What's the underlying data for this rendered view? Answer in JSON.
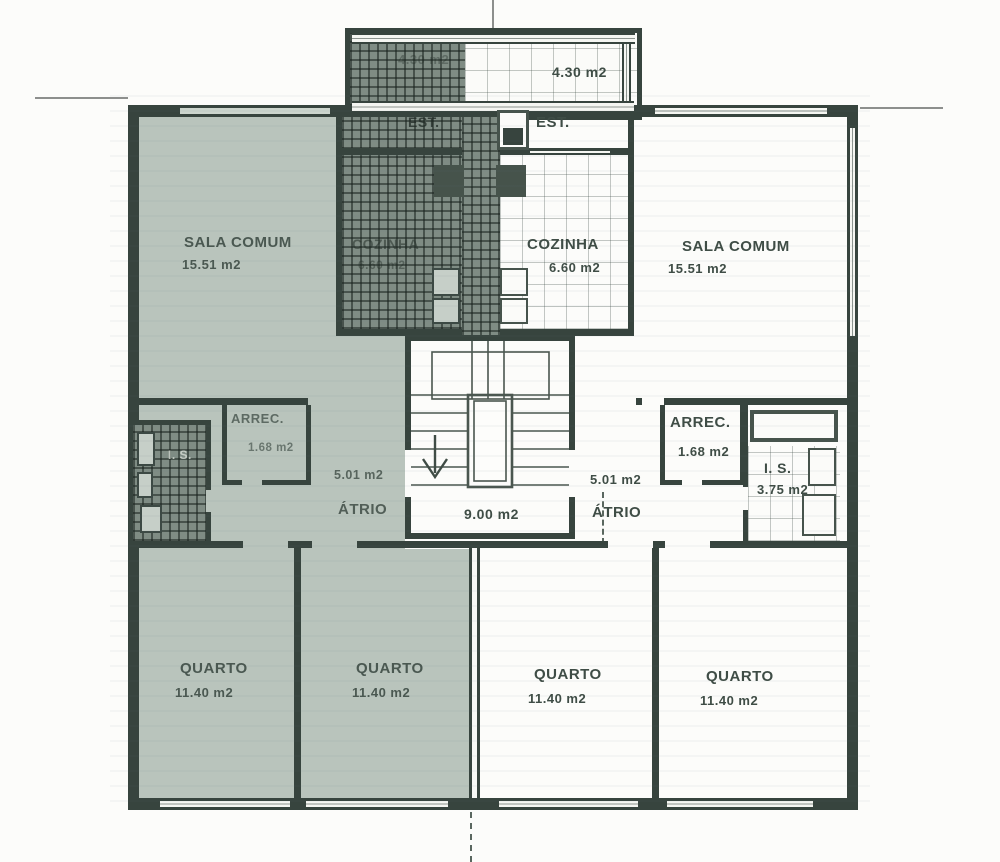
{
  "colors": {
    "highlight_tint": "#b9c4bc",
    "wall_ink": "#37443e",
    "text_ink": "#3f4d46"
  },
  "rooms": {
    "left_est": {
      "name": "EST.",
      "area": "4.30 m2"
    },
    "right_est": {
      "name": "EST.",
      "area": "4.30 m2"
    },
    "left_sala": {
      "name": "SALA COMUM",
      "area": "15.51 m2"
    },
    "right_sala": {
      "name": "SALA COMUM",
      "area": "15.51 m2"
    },
    "left_cozinha": {
      "name": "COZINHA",
      "area": "6.60 m2"
    },
    "right_cozinha": {
      "name": "COZINHA",
      "area": "6.60 m2"
    },
    "left_arrec": {
      "name": "ARREC.",
      "area": "1.68 m2"
    },
    "right_arrec": {
      "name": "ARREC.",
      "area": "1.68 m2"
    },
    "left_is": {
      "name": "I. S."
    },
    "right_is": {
      "name": "I. S.",
      "area": "3.75 m2"
    },
    "left_atrio": {
      "name": "ÁTRIO",
      "area": "5.01 m2"
    },
    "right_atrio": {
      "name": "ÁTRIO",
      "area": "5.01 m2"
    },
    "stairwell": {
      "area": "9.00 m2"
    },
    "left_quarto_1": {
      "name": "QUARTO",
      "area": "11.40 m2"
    },
    "left_quarto_2": {
      "name": "QUARTO",
      "area": "11.40 m2"
    },
    "right_quarto_1": {
      "name": "QUARTO",
      "area": "11.40 m2"
    },
    "right_quarto_2": {
      "name": "QUARTO",
      "area": "11.40 m2"
    }
  }
}
